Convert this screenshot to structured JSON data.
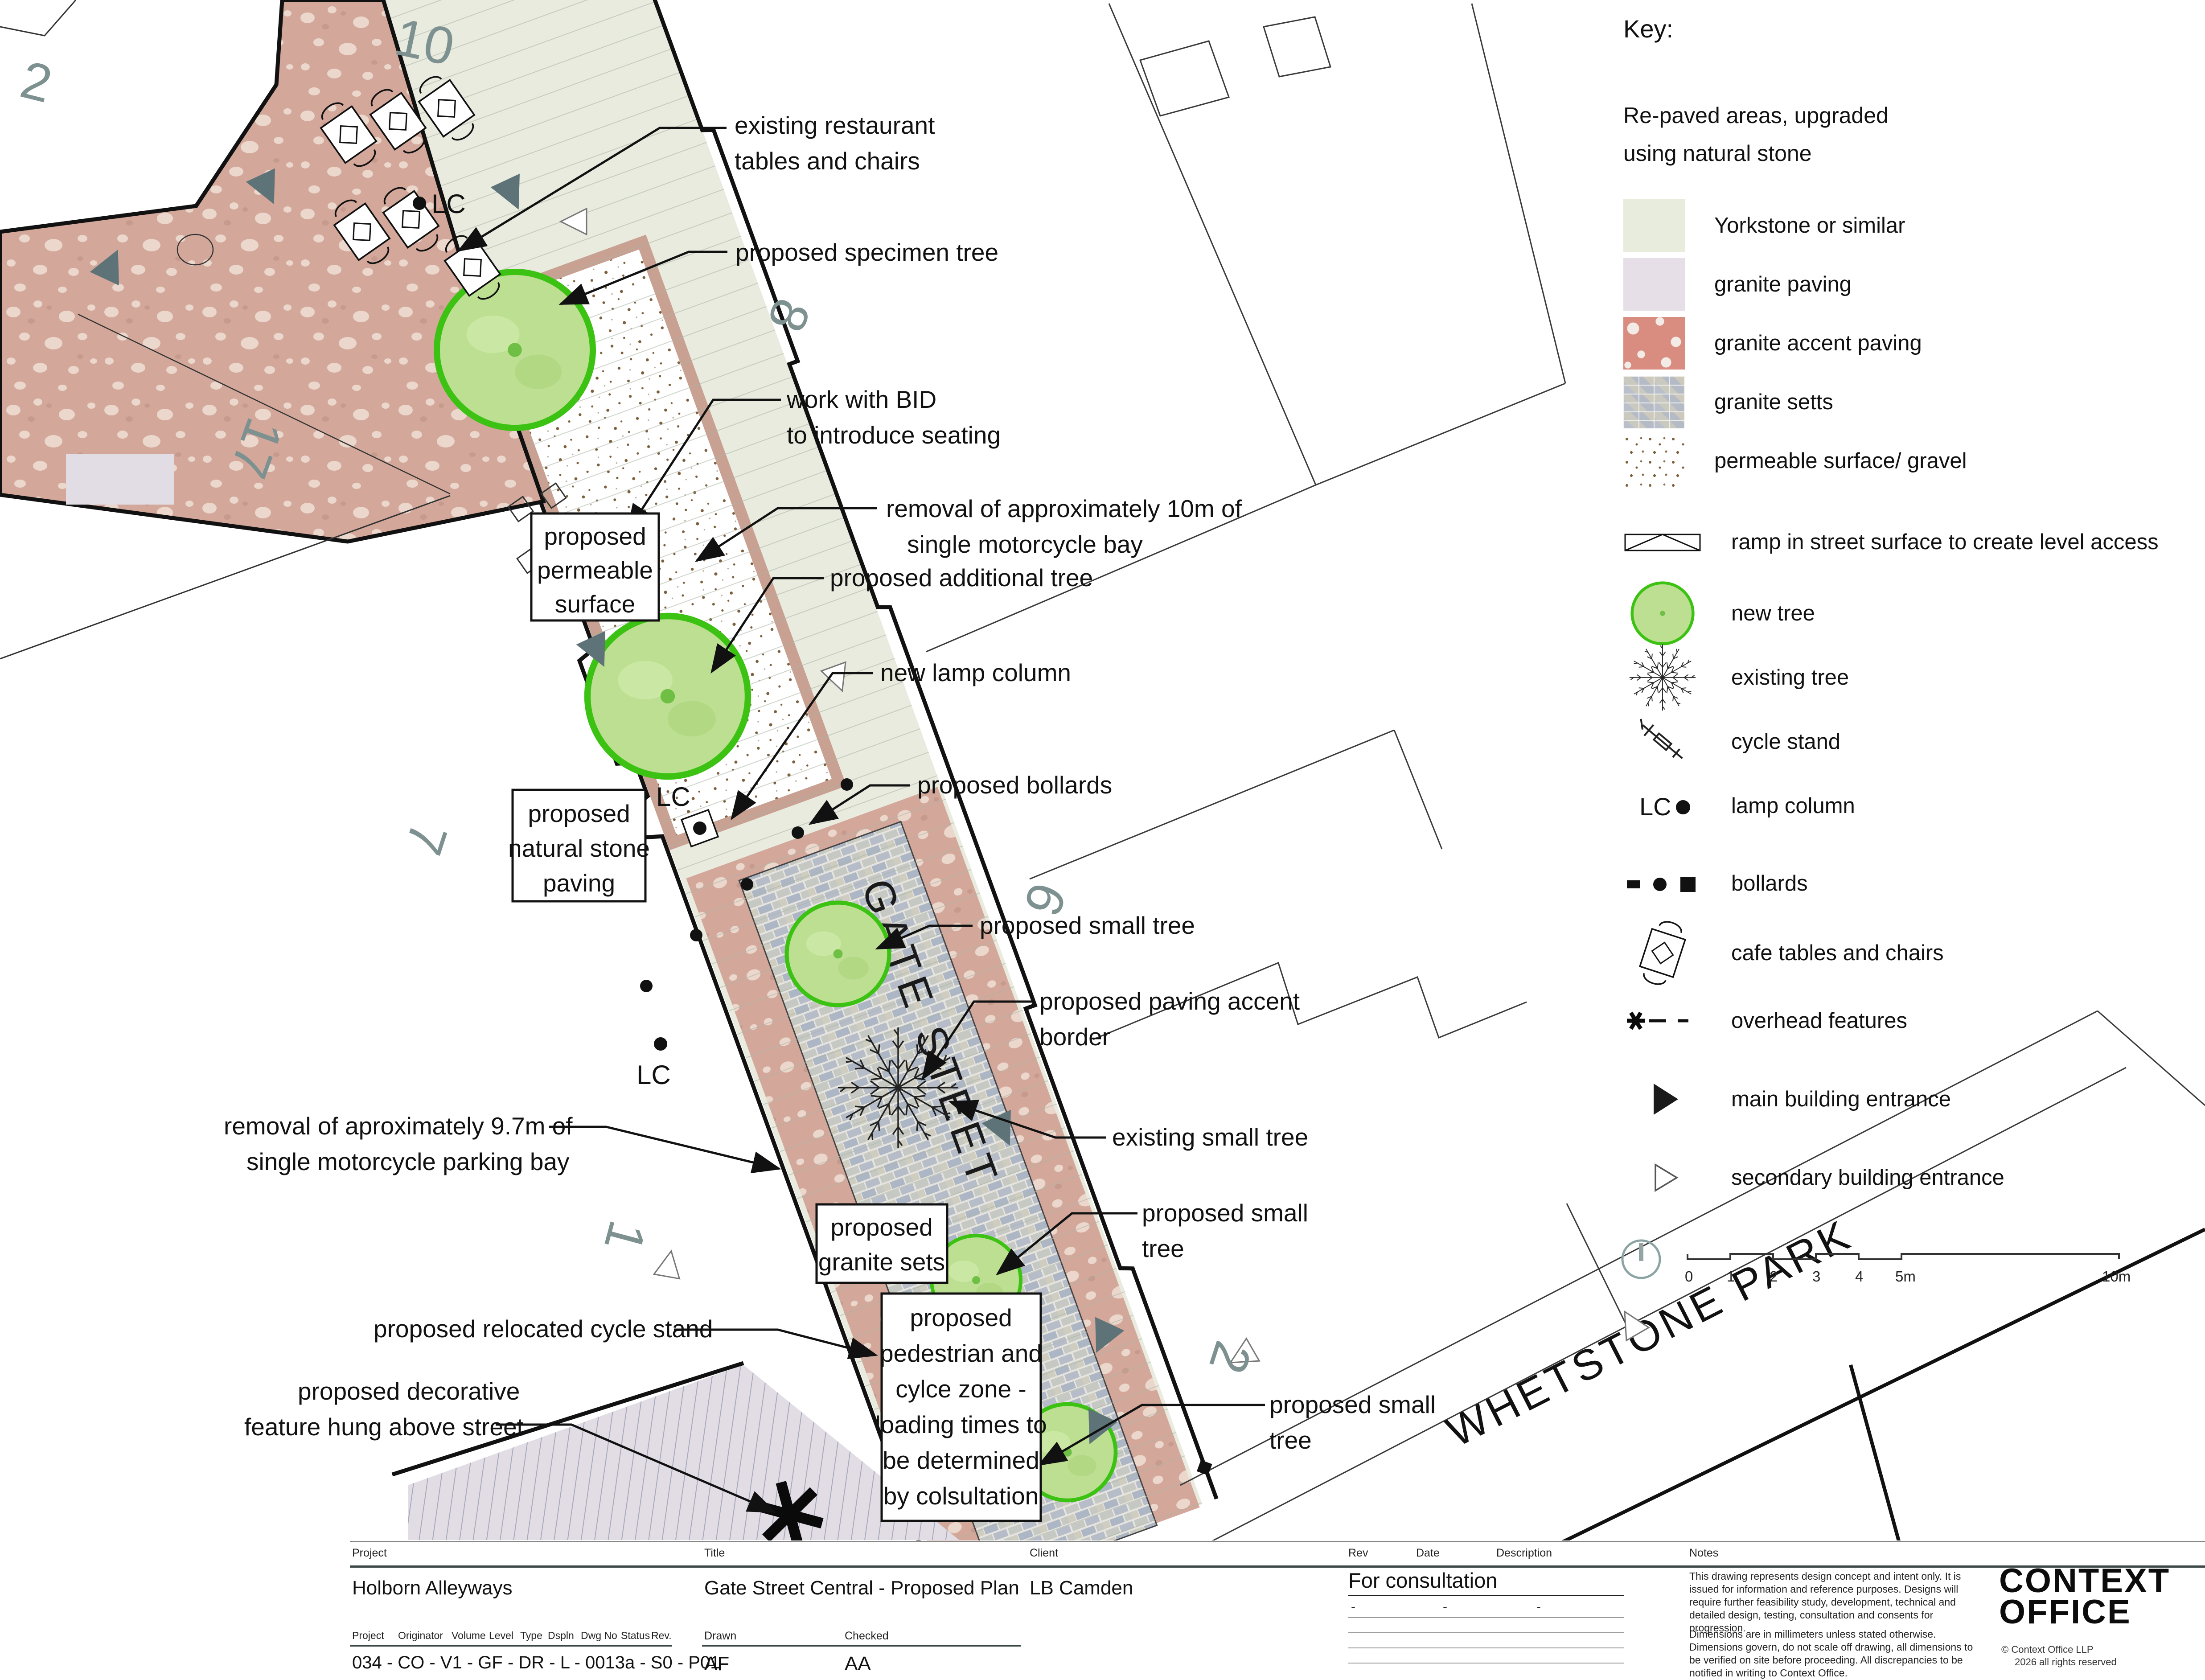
{
  "colors": {
    "yorkstone": "#e9ebdf",
    "accent": "#d3a89b",
    "granite": "#e2dde5",
    "setts_base": "#e6e4de",
    "tree_fill": "#bcdf92",
    "tree_stroke": "#3cc212",
    "numeral": "#7d9190",
    "entrance": "#5d7377"
  },
  "plan": {
    "street_label": "GATE STEET",
    "park_label": "WHETSTONE PARK",
    "lc": "LC",
    "numerals": [
      "2",
      "10",
      "17",
      "8",
      "7",
      "1",
      "6",
      "2"
    ],
    "callouts": {
      "restaurant": {
        "l1": "existing restaurant",
        "l2": "tables and chairs"
      },
      "specimen": {
        "l1": "proposed specimen tree"
      },
      "bid": {
        "l1": "work with BID",
        "l2": "to introduce seating"
      },
      "removal10": {
        "l1": "removal of approximately 10m of",
        "l2": "single motorcycle bay"
      },
      "additional": {
        "l1": "proposed additional tree"
      },
      "lamp": {
        "l1": "new lamp column"
      },
      "bollards": {
        "l1": "proposed bollards"
      },
      "small1": {
        "l1": "proposed small tree"
      },
      "accent": {
        "l1": "proposed paving accent",
        "l2": "border"
      },
      "existing": {
        "l1": "existing small tree"
      },
      "small2": {
        "l1": "proposed small",
        "l2": "tree"
      },
      "small3": {
        "l1": "proposed small",
        "l2": "tree"
      },
      "removal97": {
        "l1": "removal of aproximately 9.7m of",
        "l2": "single motorcycle parking bay"
      },
      "relocated": {
        "l1": "proposed relocated cycle stand"
      },
      "decorative": {
        "l1": "proposed decorative",
        "l2": "feature hung above street"
      }
    },
    "boxes": {
      "permeable": {
        "l1": "proposed",
        "l2": "permeable",
        "l3": "surface"
      },
      "stone": {
        "l1": "proposed",
        "l2": "natural stone",
        "l3": "paving"
      },
      "setts": {
        "l1": "proposed",
        "l2": "granite sets"
      },
      "pedzone": {
        "l1": "proposed",
        "l2": "pedestrian and",
        "l3": "cylce zone -",
        "l4": "loading times to",
        "l5": "be determined",
        "l6": "by colsultation"
      }
    }
  },
  "key": {
    "title": "Key:",
    "intro1": "Re-paved areas, upgraded",
    "intro2": "using natural stone",
    "swatches": [
      {
        "label": "Yorkstone or similar"
      },
      {
        "label": "granite paving"
      },
      {
        "label": "granite accent paving"
      },
      {
        "label": "granite setts"
      },
      {
        "label": "permeable surface/ gravel"
      }
    ],
    "symbols": [
      {
        "label": "ramp in street surface to create level access"
      },
      {
        "label": "new tree"
      },
      {
        "label": "existing tree"
      },
      {
        "label": "cycle stand"
      },
      {
        "label": "lamp column"
      },
      {
        "label": "bollards"
      },
      {
        "label": "cafe tables and chairs"
      },
      {
        "label": "overhead features"
      },
      {
        "label": "main building entrance"
      },
      {
        "label": "secondary building entrance"
      }
    ],
    "lc": "LC",
    "scale_ticks": [
      "0",
      "1",
      "2",
      "3",
      "4",
      "5m",
      "10m"
    ]
  },
  "titleblock": {
    "project_label": "Project",
    "project": "Holborn Alleyways",
    "title_label": "Title",
    "title": "Gate Street Central - Proposed Plan",
    "client_label": "Client",
    "client": "LB Camden",
    "rev_label": "Rev",
    "date_label": "Date",
    "desc_label": "Description",
    "notes_label": "Notes",
    "consultation": "For consultation",
    "dash1": "-",
    "dash2": "-",
    "dash3": "-",
    "nh": {
      "h1": "Project",
      "h2": "Originator",
      "h3": "Volume",
      "h4": "Level",
      "h5": "Type",
      "h6": "Dspln",
      "h7": "Dwg No",
      "h8": "Status",
      "h9": "Rev."
    },
    "number_string": "034 - CO - V1 - GF - DR - L - 0013a - S0 - P01",
    "drawn_label": "Drawn",
    "drawn": "AF",
    "checked_label": "Checked",
    "checked": "AA",
    "notes1": "This drawing represents design concept and intent only. It is issued for information and reference purposes. Designs will require further feasibility study, development, technical and detailed design, testing, consultation and consents for progression.",
    "notes2": "Dimensions are in millimeters unless stated otherwise. Dimensions govern, do not scale off drawing, all dimensions to be verified on site before proceeding. All discrepancies to be notified in writing to Context Office.",
    "logo1": "CONTEXT",
    "logo2": "OFFICE",
    "copyright": "© Context Office LLP",
    "rights": "2026 all rights reserved"
  }
}
